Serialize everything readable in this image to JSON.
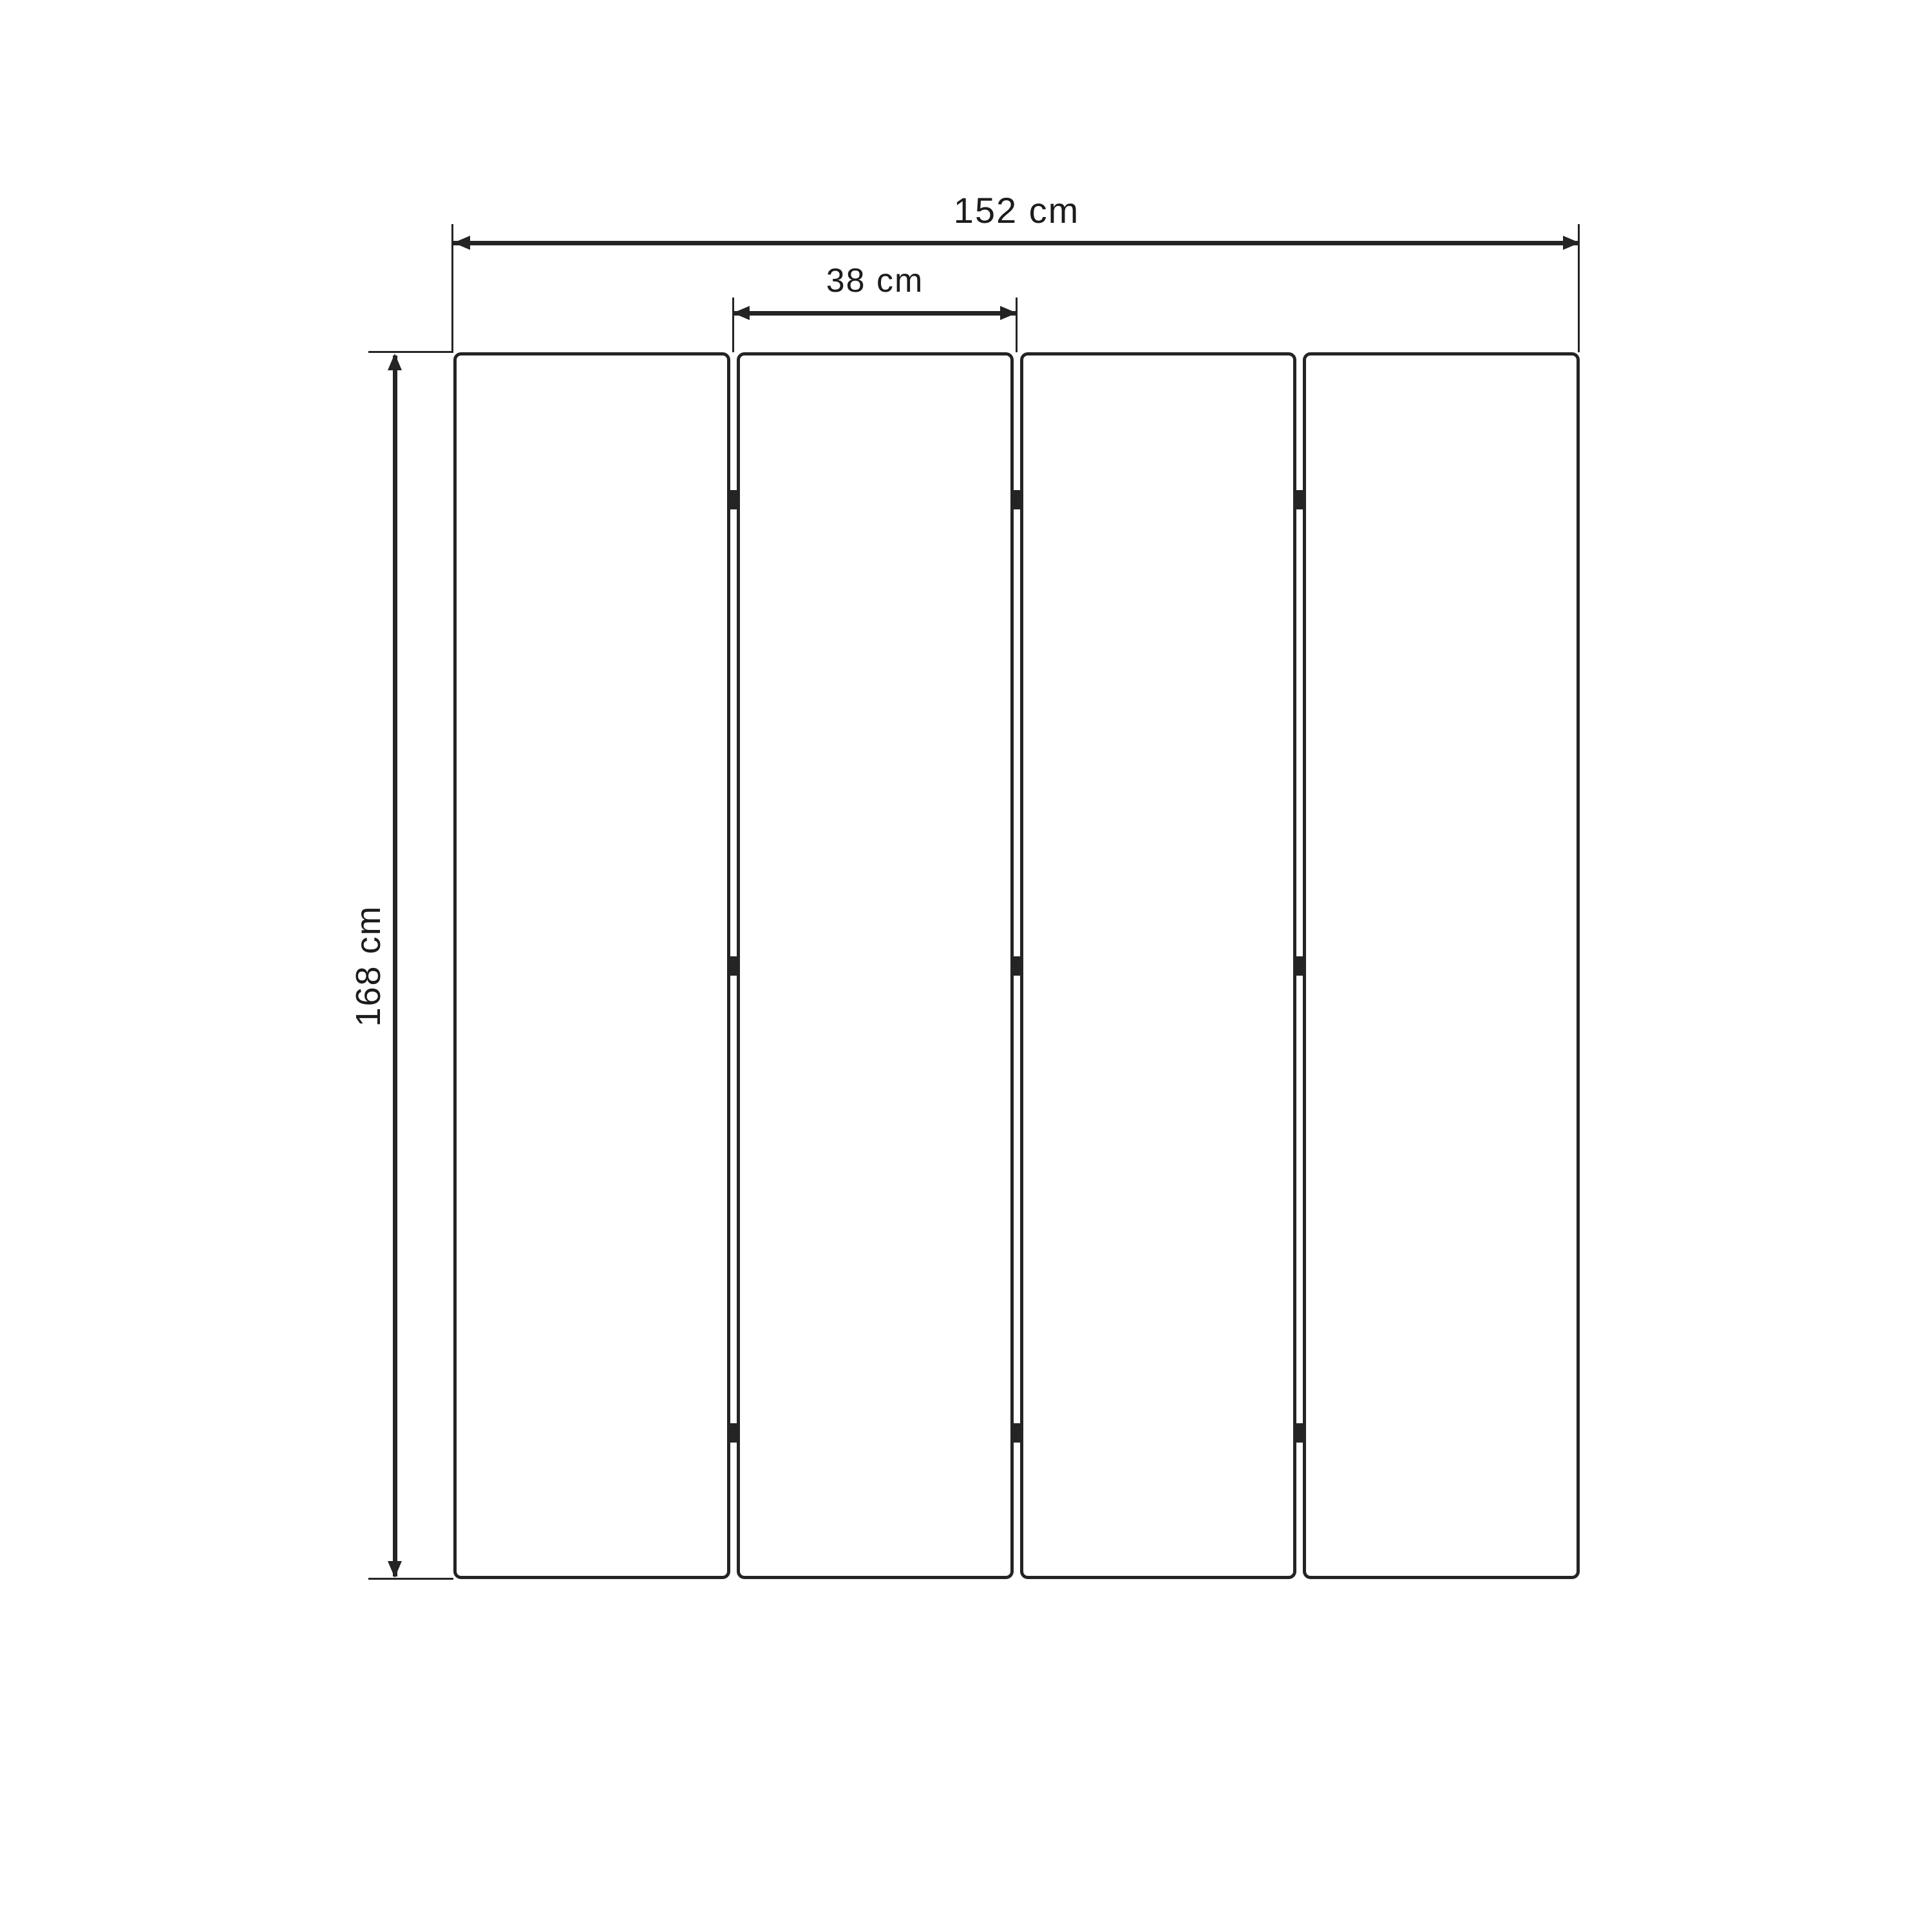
{
  "dimensions": {
    "total_width": {
      "label": "152 cm",
      "value": 152,
      "unit": "cm"
    },
    "panel_width": {
      "label": "38 cm",
      "value": 38,
      "unit": "cm"
    },
    "height": {
      "label": "168 cm",
      "value": 168,
      "unit": "cm"
    }
  },
  "panels": {
    "count": 4,
    "hinge_junctions": 3,
    "hinges_per_junction": 3
  },
  "colors": {
    "stroke": "#242424",
    "text": "#1c1c1c",
    "background": "#ffffff"
  }
}
